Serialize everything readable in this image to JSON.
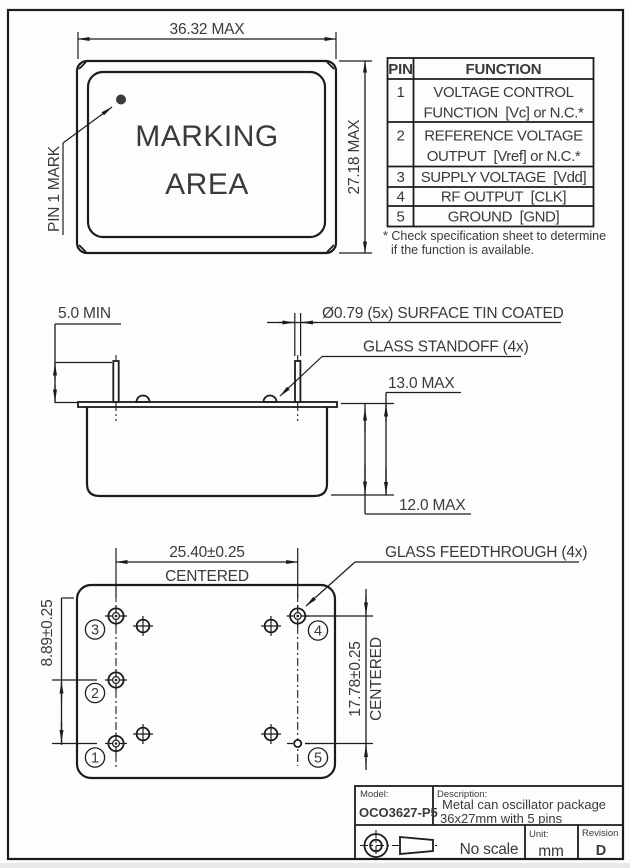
{
  "front_view": {
    "dim_width": "36.32 MAX",
    "dim_height": "27.18 MAX",
    "marking_area_line1": "MARKING",
    "marking_area_line2": "AREA",
    "pin1_mark_label": "PIN 1 MARK"
  },
  "pin_table": {
    "headers": {
      "pin": "PIN",
      "function": "FUNCTION"
    },
    "rows": [
      {
        "pin": "1",
        "line1": "VOLTAGE CONTROL",
        "line2": "FUNCTION  [Vc] or N.C.*"
      },
      {
        "pin": "2",
        "line1": "REFERENCE VOLTAGE",
        "line2": "OUTPUT  [Vref] or N.C.*"
      },
      {
        "pin": "3",
        "line1": "SUPPLY VOLTAGE  [Vdd]"
      },
      {
        "pin": "4",
        "line1": "RF OUTPUT  [CLK]"
      },
      {
        "pin": "5",
        "line1": "GROUND  [GND]"
      }
    ],
    "footnote_line1": "* Check specification sheet to determine",
    "footnote_line2": "if the function is available."
  },
  "side_view": {
    "dim_pin_length": "5.0 MIN",
    "pin_diameter_note": "Ø0.79 (5x) SURFACE TIN COATED",
    "glass_standoff_label": "GLASS STANDOFF (4x)",
    "dim_total_height": "13.0 MAX",
    "dim_can_height": "12.0 MAX"
  },
  "bottom_view": {
    "dim_pin_span_h": "25.40±0.25",
    "dim_pin_span_h_note": "CENTERED",
    "dim_pin_pitch": "8.89±0.25",
    "dim_pin_span_v": "17.78±0.25",
    "dim_pin_span_v_note": "CENTERED",
    "glass_feedthrough_label": "GLASS FEEDTHROUGH (4x)",
    "pin_numbers": [
      "1",
      "2",
      "3",
      "4",
      "5"
    ]
  },
  "title_block": {
    "model_label": "Model:",
    "model": "OCO3627-P5",
    "description_label": "Description:",
    "description_line1": "Metal can oscillator package",
    "description_line2": "36x27mm with 5 pins",
    "scale": "No scale",
    "unit_label": "Unit:",
    "unit": "mm",
    "revision_label": "Revision",
    "revision": "D"
  },
  "colors": {
    "line": "#1c1c1c",
    "text": "#3a3a3a",
    "background": "#fdfdfd"
  }
}
